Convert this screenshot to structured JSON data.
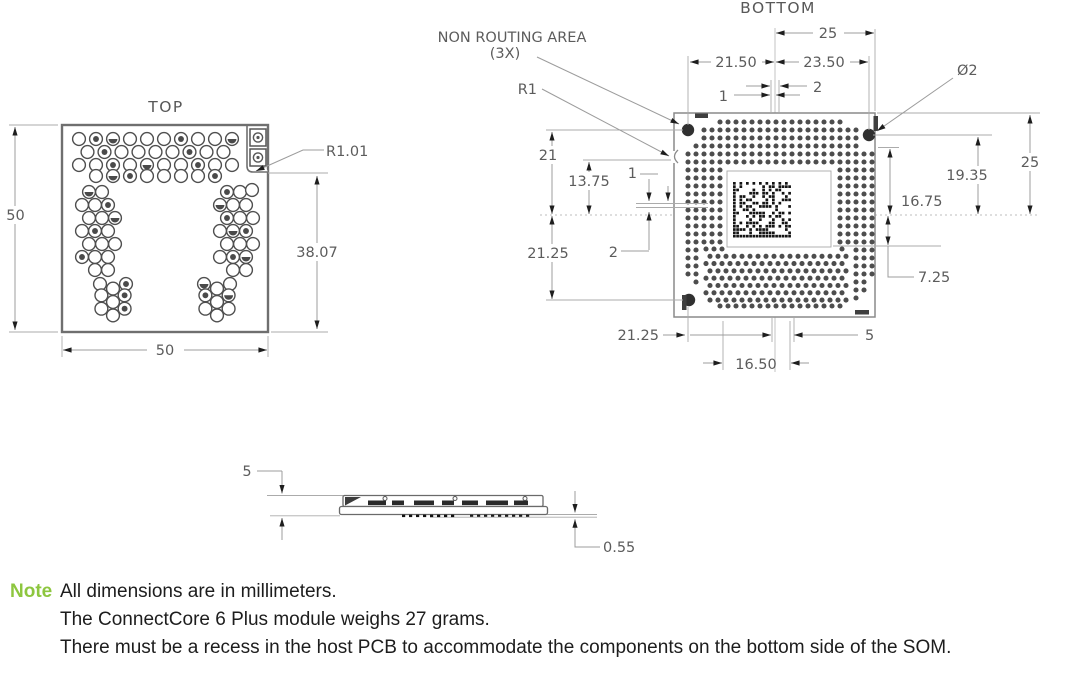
{
  "titles": {
    "top_view": "TOP",
    "bottom_view": "BOTTOM"
  },
  "callouts": {
    "non_routing_area": "NON ROUTING AREA",
    "non_routing_qty": "(3X)",
    "r1": "R1",
    "r1_01": "R1.01",
    "dia_2": "Ø2"
  },
  "dims": {
    "top_width": "50",
    "top_height": "50",
    "top_right": "38.07",
    "b_25": "25",
    "b_21_50": "21.50",
    "b_23_50": "23.50",
    "b_2": "2",
    "b_1": "1",
    "b_21": "21",
    "b_13_75": "13.75",
    "b_21_25": "21.25",
    "b_19_35": "19.35",
    "b_16_75": "16.75",
    "b_7_25": "7.25",
    "b_16_50": "16.50",
    "b_5": "5",
    "side_height": "5",
    "side_standoff": "0.55"
  },
  "note": {
    "label": "Note",
    "lines": [
      "All dimensions are in millimeters.",
      "The ConnectCore 6 Plus module weighs 27 grams.",
      "There must be a recess in the host PCB to accommodate the components on the bottom side of the SOM."
    ]
  },
  "colors": {
    "note_label": "#8dc63f",
    "dim_text": "#5c5c5c",
    "drawing_line": "#9c9c9c",
    "outline": "#6f6f6f",
    "pad_dot": "#4d4d4d"
  }
}
